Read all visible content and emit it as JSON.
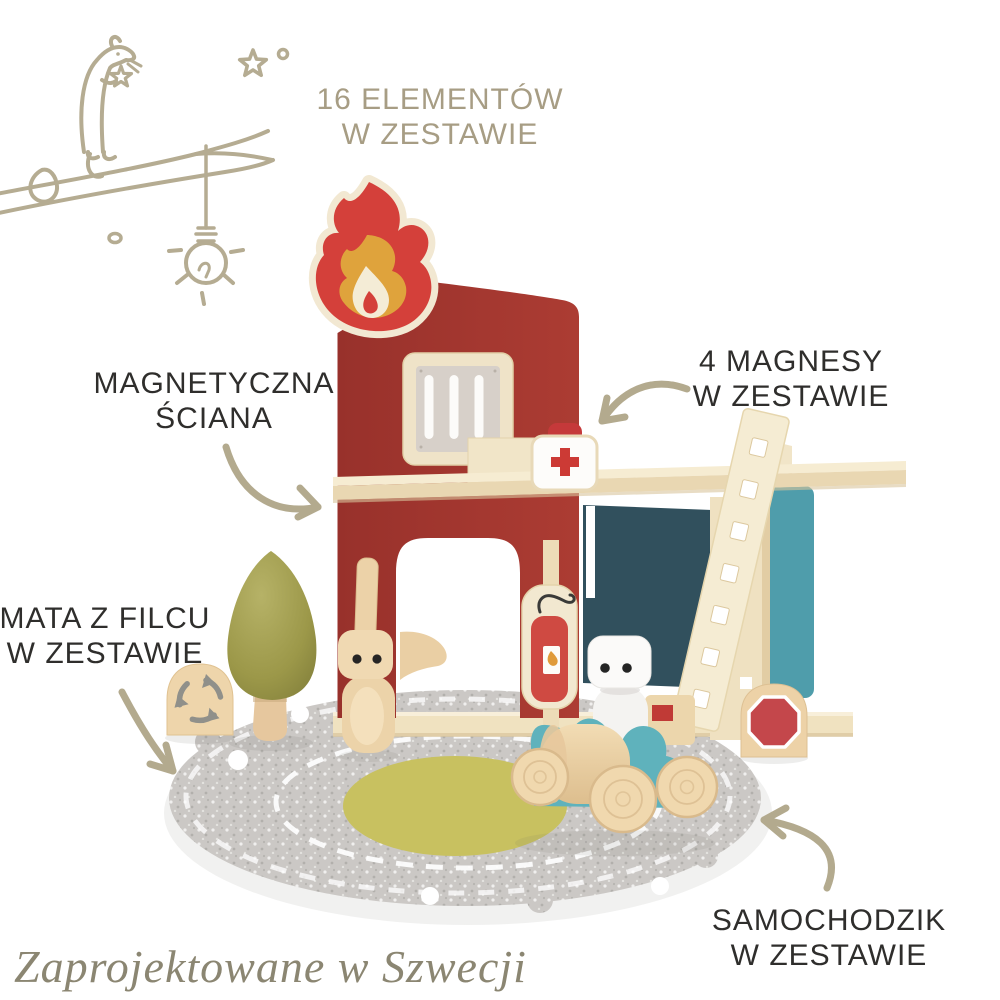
{
  "annotations": {
    "piece_count": {
      "line1": "16 ELEMENTÓW",
      "line2": "W ZESTAWIE"
    },
    "magnetic_wall": {
      "line1": "MAGNETYCZNA",
      "line2": "ŚCIANA"
    },
    "magnets": {
      "line1": "4 MAGNESY",
      "line2": "W ZESTAWIE"
    },
    "felt_mat": {
      "line1": "MATA Z FILCU",
      "line2": "W ZESTAWIE"
    },
    "toy_car": {
      "line1": "SAMOCHODZIK",
      "line2": "W ZESTAWIE"
    },
    "footer": "Zaprojektowane w Szwecji"
  },
  "scene": {
    "subject": "wooden toy fire station playset",
    "items": [
      "flame sign",
      "fire station building",
      "barred window",
      "first aid kit",
      "roof beam",
      "garage with teal walls",
      "wooden ladder",
      "fire extinguisher sign",
      "green tree",
      "rabbit figure",
      "dog figure",
      "firefighter figure",
      "roundabout sign",
      "stop sign",
      "grey felt play mat with roads",
      "wooden toy car"
    ]
  },
  "colors": {
    "annotation_dark": "#2f2e2c",
    "annotation_sand": "#a79d84",
    "sketch_taupe": "#b5ac92",
    "footer_text": "#8b8672",
    "building_red": "#a23a32",
    "flame_red": "#d4403a",
    "flame_orange": "#dfa33c",
    "cream_wood": "#f2e8d2",
    "garage_dark_teal": "#31505d",
    "garage_bright_teal": "#4f9dab",
    "car_teal": "#5fb2bc",
    "tree_olive": "#9c9849",
    "mat_grey": "#cbc8c5",
    "mat_yellow": "#c8c160",
    "sign_red": "#c4474b"
  }
}
